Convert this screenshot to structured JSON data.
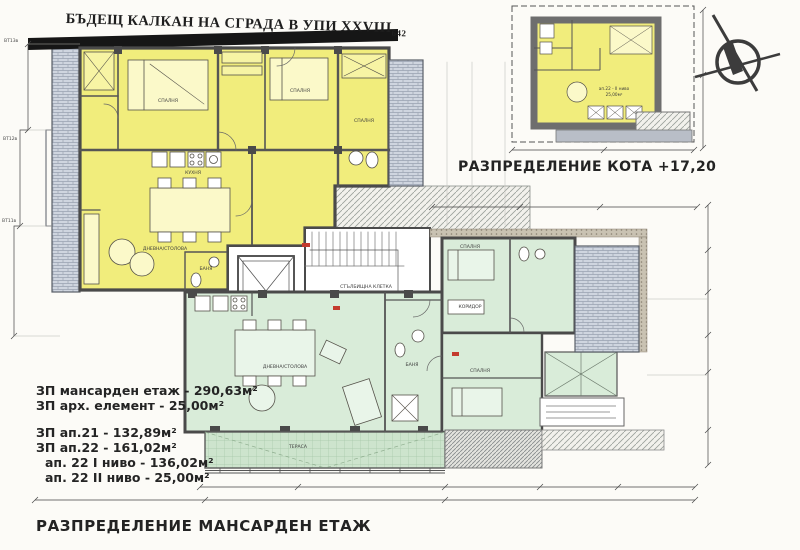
{
  "titles": {
    "top": "БЪДЕЩ КАЛКАН НА СГРАДА В УПИ XXVIII",
    "top_sub": "642",
    "kota": "РАЗПРЕДЕЛЕНИЕ КОТА +17,20",
    "bottom": "РАЗПРЕДЕЛЕНИЕ МАНСАРДЕН ЕТАЖ"
  },
  "areas": {
    "group1": [
      "ЗП мансарден етаж - 290,63м²",
      "ЗП арх. елемент - 25,00м²"
    ],
    "group2": [
      "ЗП ап.21 - 132,89м²",
      "ЗП ап.22 - 161,02м²",
      "ап. 22 I ниво - 136,02м²",
      "ап. 22 II ниво - 25,00м²"
    ]
  },
  "rooms": {
    "bedroom": "СПАЛНЯ",
    "kitchen": "КУХНЯ",
    "bath": "БАНЯ",
    "living": "ДНЕВНА/СТОЛОВА",
    "corridor": "КОРИДОР",
    "terrace": "ТЕРАСА",
    "stairs": "СТЪЛБИЩНА КЛЕТКА",
    "stairs_area": "16,75м²",
    "small_unit": "ап.22 - II ниво",
    "small_unit_area": "25,00м²"
  },
  "axis_labels": {
    "a1": "ВТ13в",
    "a2": "ВТ12в",
    "a3": "ВТ11в"
  },
  "icons": {
    "north_arrow": "north-arrow"
  },
  "colors": {
    "apartment21_fill": "#f1ed7c",
    "apartment22_fill": "#d9ecd9",
    "wall": "#4a4a4a",
    "masonry_hatch": "#cfd5df",
    "marker_red": "#c43b2e"
  }
}
